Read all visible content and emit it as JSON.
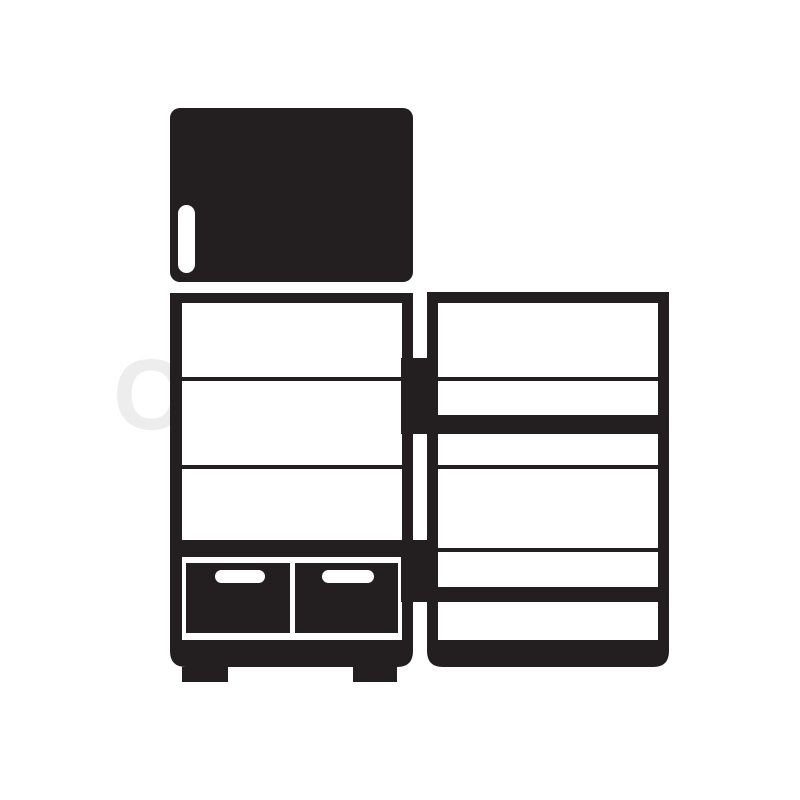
{
  "page": {
    "background_color": "#ffffff"
  },
  "icon": {
    "name": "refrigerator-icon",
    "description": "Black flat icon of a refrigerator: closed top freezer door with handle, open lower cabinet showing shelves, two bottom drawers with handle slots, and an open door with door shelves",
    "color": "#231f20",
    "interior_color": "#ffffff"
  },
  "watermark": {
    "text": "Colourbox",
    "color": "#ededed"
  }
}
